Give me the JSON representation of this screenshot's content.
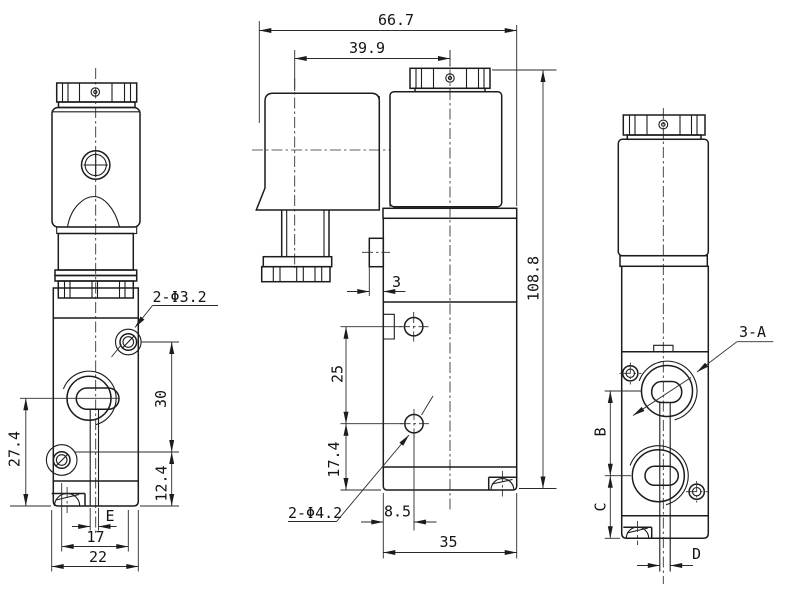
{
  "drawing": {
    "type": "solenoid-valve-dimension-drawing",
    "line_color": "#1c1c1c",
    "background": "#ffffff",
    "dims": {
      "overall_width": "66.7",
      "coil_center_offset": "39.9",
      "overall_height": "108.8",
      "front_holes_label": "2-Φ3.2",
      "front_hole_spacing": "30",
      "front_center_to_bottom": "27.4",
      "front_hole_to_bottom": "12.4",
      "front_slot_width": "E",
      "front_holes_pitch": "17",
      "front_width": "22",
      "side_tab_depth": "3",
      "side_port_pitch": "25",
      "side_port_to_bottom": "17.4",
      "side_holes_label": "2-Φ4.2",
      "side_hole_offset": "8.5",
      "side_width": "35",
      "ports_label": "3-A",
      "port_pitch": "B",
      "port_to_bottom": "C",
      "slot_width": "D"
    }
  }
}
